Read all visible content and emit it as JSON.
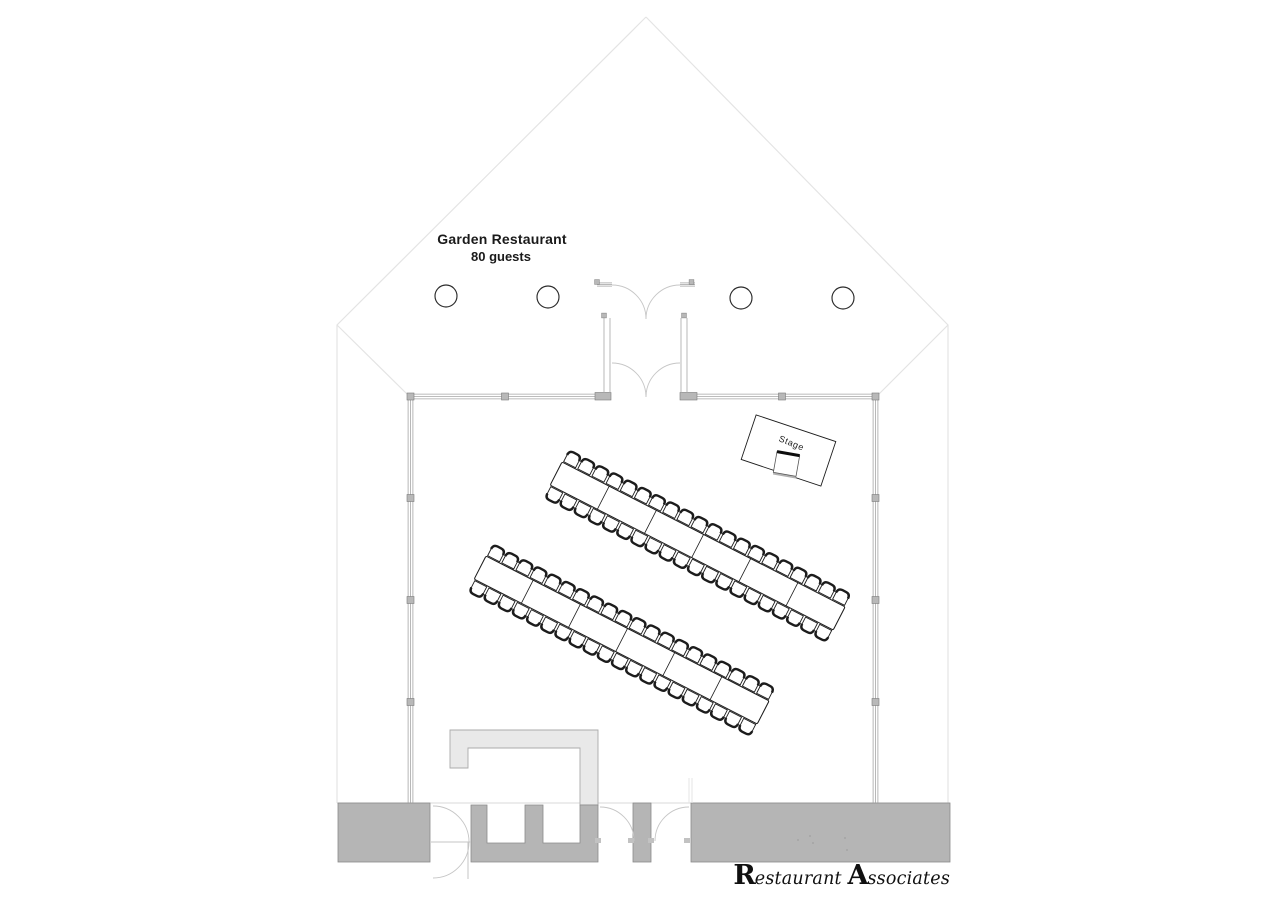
{
  "meta": {
    "width": 1280,
    "height": 905,
    "background": "#ffffff"
  },
  "labels": {
    "title_line1": "Garden Restaurant",
    "title_line2": "80 guests",
    "stage": "Stage",
    "logo": {
      "cap1": "R",
      "rest1": "estaurant ",
      "cap2": "A",
      "rest2": "ssociates"
    }
  },
  "colors": {
    "ink": "#1c1c1c",
    "wall_gray": "#a6a6a6",
    "light_line": "#e4e4e4",
    "floor_line": "#dadada",
    "door_arc": "#c6c6c6",
    "block_fill": "#b5b5b5",
    "block_stroke": "#8a8a8a",
    "counter_fill": "#e9e9e9",
    "counter_stroke": "#ababab",
    "post_fill": "#b8b8b8",
    "post_stroke": "#7a7a7a",
    "column_stroke": "#2b2b2b",
    "dot": "#8f8f8f"
  },
  "plan": {
    "garden_outline": {
      "apex": [
        646,
        17
      ],
      "left_corner": [
        337,
        325
      ],
      "right_corner": [
        948,
        325
      ],
      "left_wall_bottom": [
        337,
        803
      ],
      "right_wall_bottom": [
        948,
        803
      ],
      "room_tl": [
        408,
        395
      ],
      "room_tr": [
        878,
        395
      ]
    },
    "room": {
      "left_x": 410.5,
      "right_x": 875.5,
      "top_y": 396.5,
      "bottom_y": 803,
      "line_gap": 2.4,
      "top_wall_segments": [
        [
          408,
          603
        ],
        [
          689,
          878
        ]
      ],
      "posts_top_x": [
        410.5,
        505,
        782,
        875.5
      ],
      "posts_side_y": [
        498,
        600,
        702
      ],
      "jamb_blocks": [
        [
          595,
          392.5,
          16,
          7.5
        ],
        [
          680,
          392.5,
          17,
          7.5
        ]
      ]
    },
    "vestibule": {
      "top_y": 284.5,
      "top_stubs": [
        [
          597,
          612
        ],
        [
          680,
          695
        ]
      ],
      "side_y1": 318,
      "side_y2": 393,
      "side_left_x": [
        604,
        610
      ],
      "side_right_x": [
        681,
        687
      ],
      "small_squares": [
        [
          597,
          282
        ],
        [
          691.5,
          282
        ],
        [
          604,
          315.5
        ],
        [
          684,
          315.5
        ]
      ],
      "outer_door": {
        "left_hinge": [
          612,
          285
        ],
        "right_hinge": [
          680,
          285
        ],
        "meet": [
          646,
          319
        ],
        "r": 34
      },
      "inner_door": {
        "left_hinge": [
          612,
          363
        ],
        "right_hinge": [
          680,
          363
        ],
        "meet": [
          646,
          397
        ],
        "r": 34
      }
    },
    "columns": {
      "centers": [
        [
          446,
          296
        ],
        [
          548,
          297
        ],
        [
          741,
          298
        ],
        [
          843,
          298
        ]
      ],
      "r": 11
    },
    "tables": {
      "angle": 27.1,
      "length": 318,
      "width": 26,
      "segments": 6,
      "rows": [
        [
          562,
          462
        ],
        [
          486,
          556
        ]
      ],
      "chairs_per_side": 20,
      "spacing": 15.9,
      "first_offset": 8,
      "chair_half_w": 6.7,
      "chair_front": 1.1,
      "chair_back": 13.7,
      "chair_corner": 4.6
    },
    "stage": {
      "cx": 788.5,
      "cy": 450.5,
      "w": 84,
      "h": 47,
      "angle": 18.5,
      "label_rot": 22,
      "podium": {
        "cx": 786.5,
        "cy": 464,
        "w": 23,
        "h": 21,
        "angle": 10
      }
    },
    "service": {
      "floor_line": {
        "y": 803,
        "x1": 337,
        "x2": 950
      },
      "blocks": [
        [
          338,
          803,
          92,
          59
        ],
        [
          633,
          803,
          18,
          59
        ],
        [
          691,
          803,
          259,
          59
        ]
      ],
      "comb": [
        [
          471,
          805
        ],
        [
          487,
          805
        ],
        [
          487,
          843
        ],
        [
          525,
          843
        ],
        [
          525,
          805
        ],
        [
          543,
          805
        ],
        [
          543,
          843
        ],
        [
          580,
          843
        ],
        [
          580,
          805
        ],
        [
          598,
          805
        ],
        [
          598,
          862
        ],
        [
          471,
          862
        ]
      ],
      "counter": [
        [
          450,
          730
        ],
        [
          598,
          730
        ],
        [
          598,
          805
        ],
        [
          580,
          805
        ],
        [
          580,
          748
        ],
        [
          468,
          748
        ],
        [
          468,
          768
        ],
        [
          450,
          768
        ]
      ],
      "swing_door": {
        "arcs": [
          [
            "M433,806 A36,36 0 0 1 469,842"
          ],
          [
            "M433,878 A36,36 0 0 0 469,842"
          ]
        ],
        "lines": [
          [
            431,
            842,
            471,
            842
          ],
          [
            468,
            842,
            468,
            879
          ]
        ]
      },
      "arc_doors": [
        "M600,807 A34,34 0 0 1 634,841",
        "M689,807 A34,34 0 0 0 655,841"
      ],
      "jamb_marks": [
        [
          595,
          838
        ],
        [
          628,
          838
        ],
        [
          648,
          838
        ],
        [
          684,
          838
        ]
      ],
      "stub_wall": {
        "x": [
          689,
          692
        ],
        "y1": 778,
        "y2": 803
      },
      "dots": [
        [
          798,
          840
        ],
        [
          810,
          836
        ],
        [
          813,
          843
        ],
        [
          845,
          838
        ],
        [
          847,
          850
        ]
      ]
    }
  }
}
